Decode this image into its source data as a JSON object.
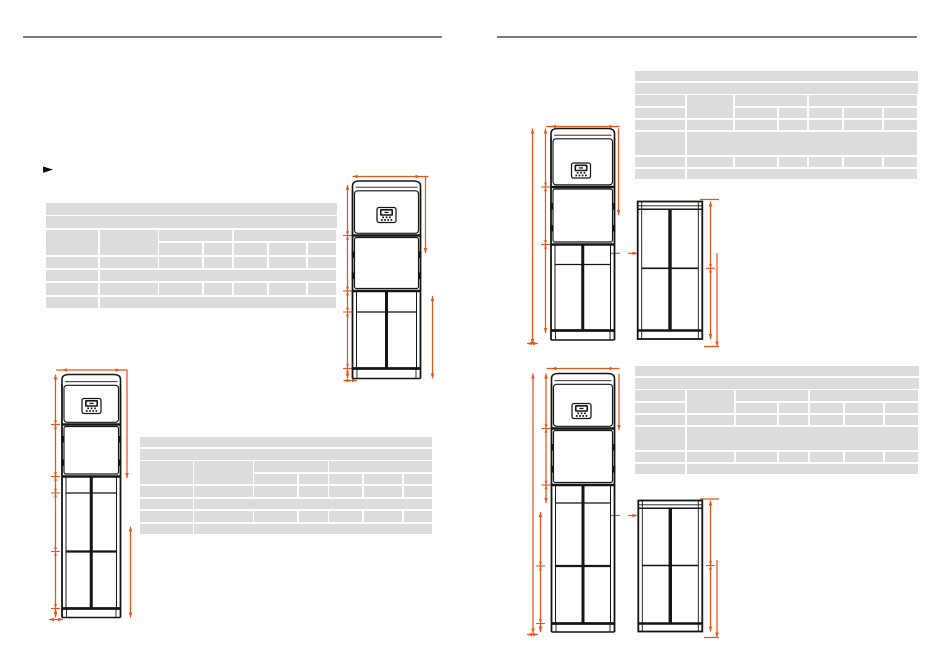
{
  "page": {
    "background": "#ffffff",
    "type": "technical-datasheet-spread",
    "columns": 2
  },
  "colors": {
    "dimension_accent": "#e8551c",
    "drawing_line": "#151515",
    "table_cell": "#dcdcdc",
    "column_rule": "#7b7b7b",
    "bullet": "#0d0d0d"
  },
  "left_column": {
    "bullet": "►"
  },
  "figures": [
    {
      "name": "front-view-top-left",
      "views": [
        "front"
      ]
    },
    {
      "name": "front-view-bottom-left",
      "views": [
        "front"
      ]
    },
    {
      "name": "front-and-side-view-top-right",
      "views": [
        "front",
        "side"
      ]
    },
    {
      "name": "front-and-side-view-bottom-right",
      "views": [
        "front",
        "side"
      ]
    }
  ],
  "tables": [
    {
      "name": "spec-table-top-left",
      "x": 45.5,
      "y": 203,
      "w": 291,
      "h": 107,
      "variant": "A",
      "col_w": [
        0.187,
        0.207,
        0.152,
        0.102,
        0.117,
        0.134,
        0.101
      ],
      "cells_text": ""
    },
    {
      "name": "spec-table-bottom-left",
      "x": 140,
      "y": 436.5,
      "w": 292,
      "h": 99.5,
      "variant": "A",
      "col_w": [
        0.187,
        0.207,
        0.152,
        0.102,
        0.117,
        0.134,
        0.101
      ],
      "cells_text": ""
    },
    {
      "name": "spec-table-top-right",
      "x": 634.5,
      "y": 71,
      "w": 283,
      "h": 110,
      "variant": "B",
      "col_w": [
        0.186,
        0.171,
        0.153,
        0.105,
        0.121,
        0.142,
        0.122
      ],
      "cells_text": ""
    },
    {
      "name": "spec-table-bottom-right",
      "x": 634.5,
      "y": 366,
      "w": 284,
      "h": 110,
      "variant": "B",
      "col_w": [
        0.186,
        0.171,
        0.153,
        0.105,
        0.121,
        0.142,
        0.122
      ],
      "cells_text": ""
    }
  ]
}
